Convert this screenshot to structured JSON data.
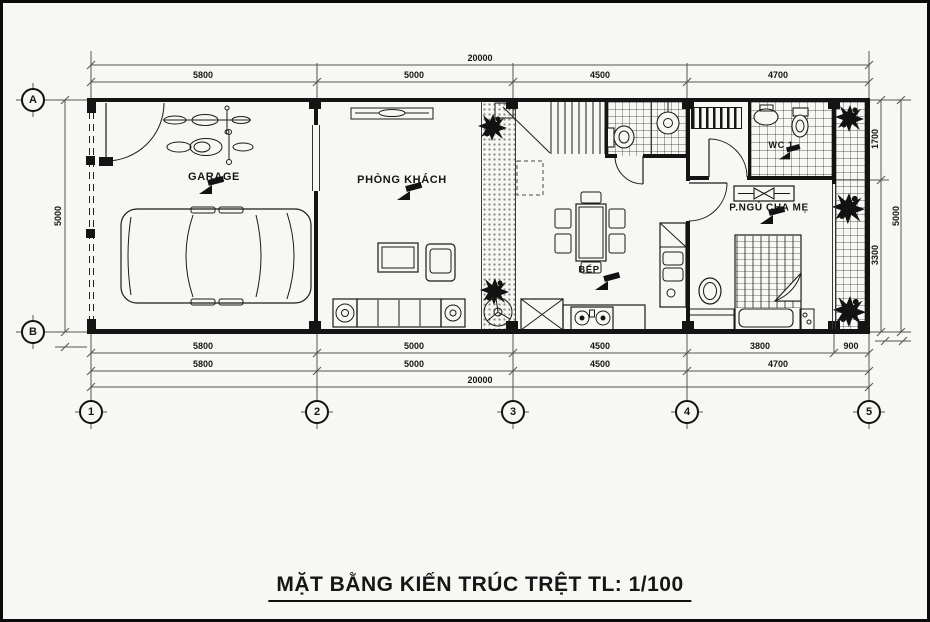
{
  "title": "MẶT BẰNG KIẾN TRÚC TRỆT TL: 1/100",
  "rooms": {
    "garage": "GARAGE",
    "living": "PHÒNG KHÁCH",
    "kitchen": "BẾP",
    "wc": "WC 1",
    "bedroom": "P.NGỦ CHA MẸ"
  },
  "grid": {
    "cols": [
      "1",
      "2",
      "3",
      "4",
      "5"
    ],
    "rows": [
      "A",
      "B"
    ]
  },
  "dims": {
    "top_overall": "20000",
    "top_segments": [
      "5800",
      "5000",
      "4500",
      "4700"
    ],
    "bottom_row1": [
      "5800",
      "5000",
      "4500",
      "3800",
      "900"
    ],
    "bottom_row2": [
      "5800",
      "5000",
      "4500",
      "4700"
    ],
    "bottom_overall": "20000",
    "left_overall": "5000",
    "right_segments": [
      "1700",
      "3300"
    ],
    "right_overall": "5000"
  }
}
